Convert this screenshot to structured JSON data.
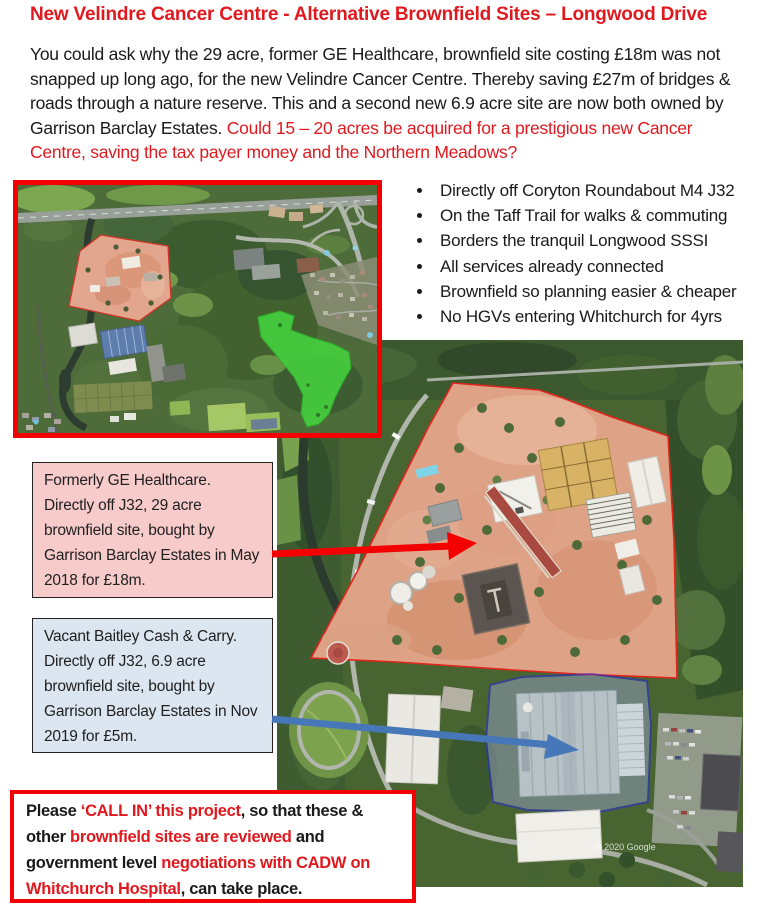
{
  "page": {
    "title": "New Velindre Cancer Centre - Alternative Brownfield Sites – Longwood Drive"
  },
  "intro": {
    "black": "You could ask why the 29 acre, former GE Healthcare, brownfield site costing £18m was not snapped up long ago, for the new Velindre Cancer Centre. Thereby saving £27m of bridges & roads through a nature reserve. This and a second new 6.9 acre site are now both owned by Garrison Barclay Estates. ",
    "red": "Could  15 – 20 acres be acquired for a prestigious new Cancer Centre, saving the tax payer money and the Northern Meadows?"
  },
  "bullets": [
    "Directly off Coryton Roundabout M4 J32",
    "On the Taff Trail for walks & commuting",
    "Borders the tranquil Longwood SSSI",
    "All services already connected",
    "Brownfield so planning easier & cheaper",
    "No HGVs entering Whitchurch for 4yrs"
  ],
  "callouts": {
    "ge": {
      "text": "Formerly GE Healthcare. Directly off J32, 29 acre brownfield site, bought by Garrison Barclay Estates in May 2018 for £18m.",
      "bg": "#f8cbcb"
    },
    "baitley": {
      "text": "Vacant Baitley Cash & Carry. Directly off J32, 6.9 acre brownfield site, bought by Garrison Barclay Estates in Nov 2019 for £5m.",
      "bg": "#dce6f1"
    }
  },
  "cta": {
    "segments": [
      {
        "text": "Please ",
        "color": "black"
      },
      {
        "text": "‘CALL IN’ this project",
        "color": "red"
      },
      {
        "text": ", so that these & other ",
        "color": "black"
      },
      {
        "text": "brownfield sites are reviewed",
        "color": "red"
      },
      {
        "text": " and government level ",
        "color": "black"
      },
      {
        "text": "negotiations with CADW on Whitchurch Hospital",
        "color": "red"
      },
      {
        "text": ", can take place.",
        "color": "black"
      }
    ]
  },
  "photos": {
    "overview": {
      "description": "Aerial overview of Longwood Drive: GE Healthcare brownfield site outlined in red, Northern Meadows highlighted green, M4 Coryton junction top right, River Taff left"
    },
    "closeup": {
      "description": "Aerial close-up: 29 acre GE site outlined red, Baitley Cash & Carry warehouse outlined blue",
      "watermark": "© 2020 Google"
    }
  },
  "colors": {
    "text_red": "#e0191f",
    "border_red": "#f50002",
    "pink_box_bg": "#f8cbcb",
    "blue_box_bg": "#dce6f1",
    "arrow_blue": "#4677b8",
    "meadow_green": "#44d33e",
    "site_pink": "#dea287"
  }
}
